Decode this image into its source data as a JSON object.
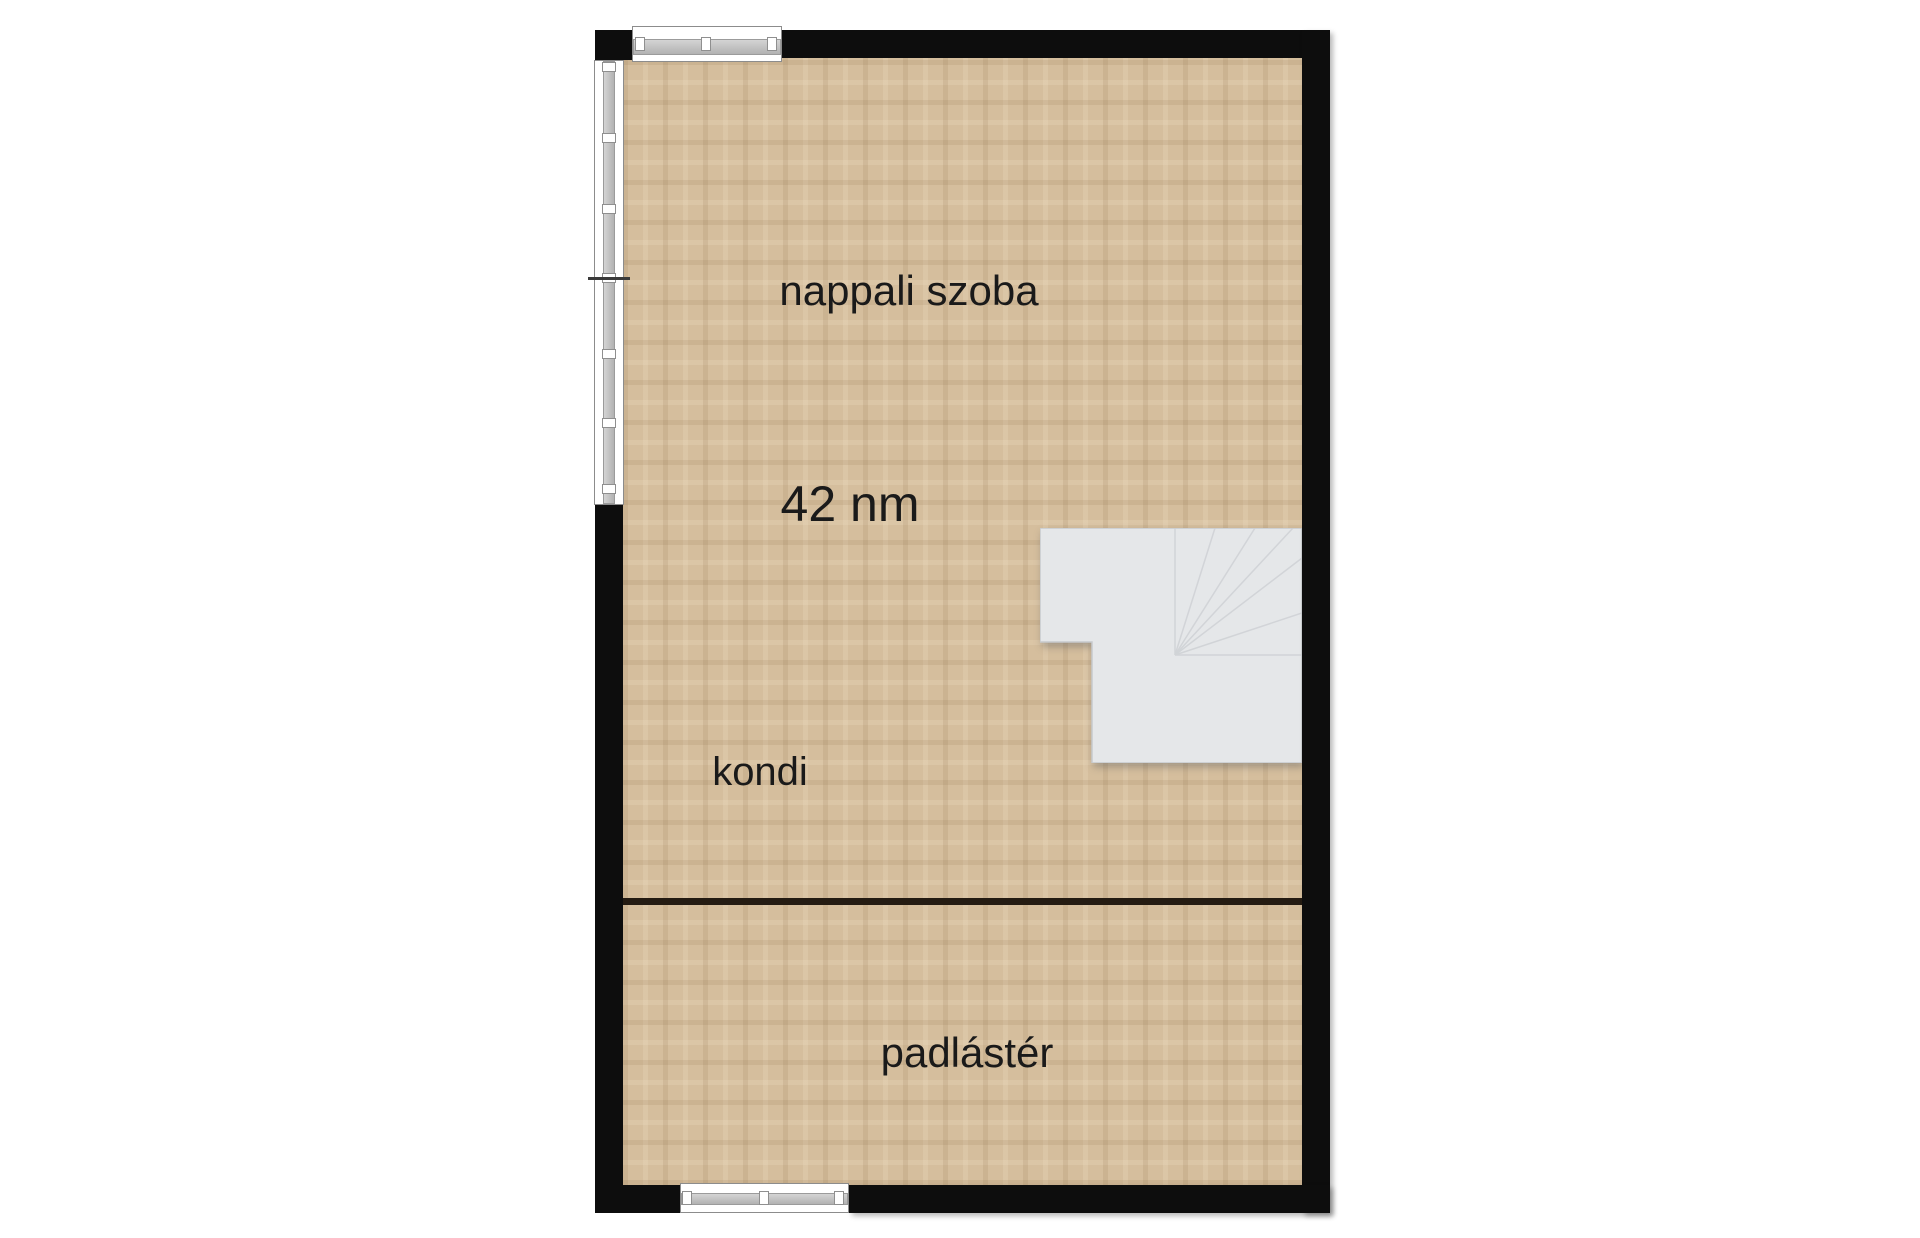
{
  "floorplan": {
    "type": "floor-plan",
    "area_label": "42 nm",
    "rooms": [
      {
        "name": "nappali szoba"
      },
      {
        "name": "kondi"
      },
      {
        "name": "padlástér"
      }
    ]
  },
  "colors": {
    "background": "#ffffff",
    "wall": "#0d0d0d",
    "floor-base": "#d5be9d",
    "floor-grain-dark": "#c2a986",
    "floor-grain-light": "#e6d3b2",
    "stair-fill": "#e5e7e9",
    "stair-line": "#cbced2",
    "stair-edge": "#c7cacd",
    "window-fill": "#ffffff",
    "window-frame": "#8c8c8c",
    "window-bar": "#bdbdbd",
    "divider": "#241b12",
    "text": "#1a1a1a"
  }
}
